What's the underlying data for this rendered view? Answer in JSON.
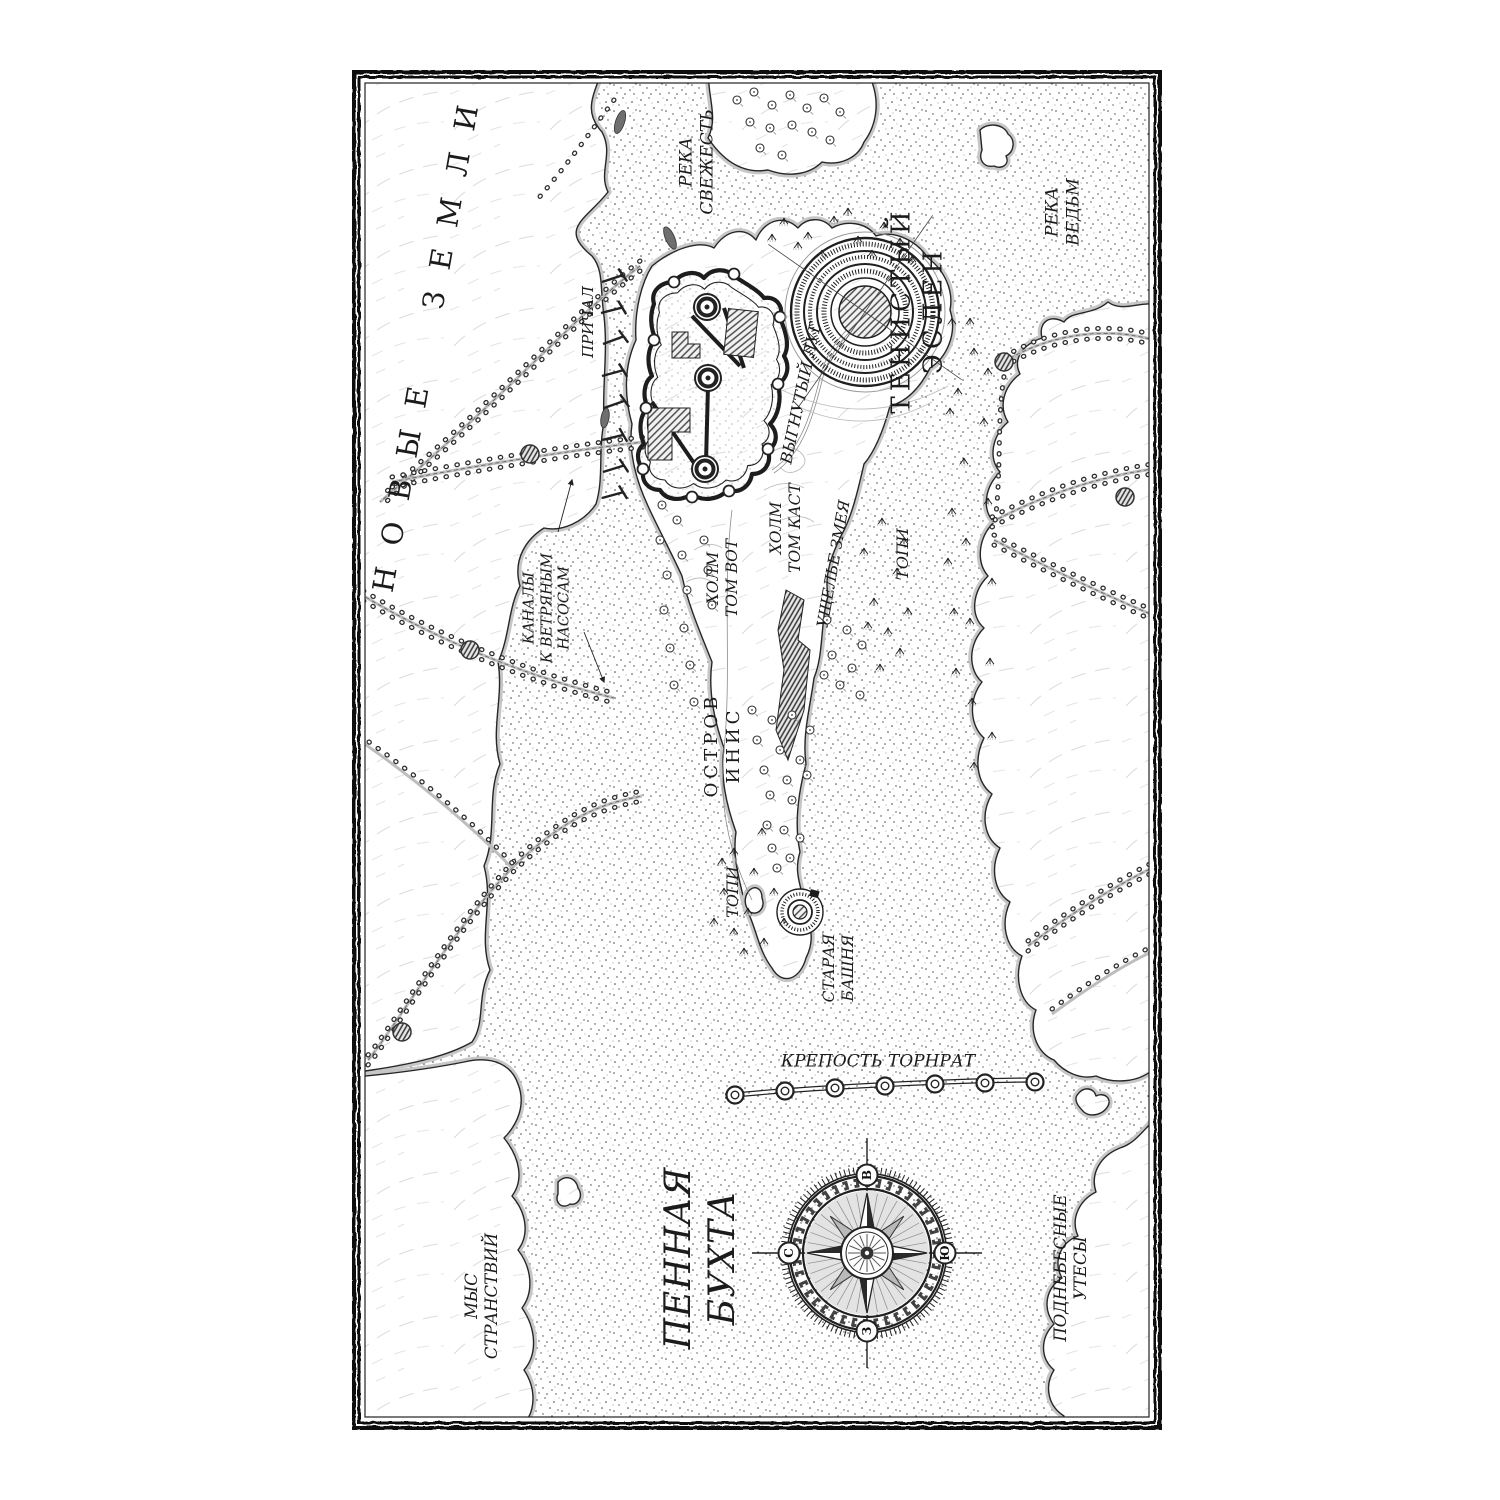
{
  "map": {
    "labels": {
      "new_lands": "НОВЫЕ ЗЕМЛИ",
      "river_svezhest": "РЕКА\nСВЕЖЕСТЬ",
      "river_vedm": "РЕКА\nВЕДЬМ",
      "prichal": "ПРИЧАЛ",
      "tenisty_eslen": "ТЕНИСТЫЙ\nЭСЛЕН",
      "vygnuty_lug": "ВЫГНУТЫЙ ЛУГ",
      "kholm_tom_kast": "ХОЛМ\nТОМ КАСТ",
      "kholm_tom_vot": "ХОЛМ\nТОМ ВОТ",
      "ushchelye_zmeya": "УЩЕЛЬЕ ЗМЕЯ",
      "topi_east": "ТОПИ",
      "kanaly": "КАНАЛЫ\nК ВЕТРЯНЫМ\nНАСОСАМ",
      "ostrov_inis": "ОСТРОВ\nИНИС",
      "topi_south": "ТОПИ",
      "staraya_bashnya": "СТАРАЯ\nБАШНЯ",
      "krepost_tornrat": "КРЕПОСТЬ ТОРНРАТ",
      "pennaya_bukhta": "ПЕННАЯ\nБУХТА",
      "mys_stranstviy": "МЫС\nСТРАНСТВИЙ",
      "podnebesnye_utesy": "ПОДНЕБЕСНЫЕ\nУТЕСЫ"
    },
    "compass": {
      "north": "С",
      "east": "В",
      "south": "Ю",
      "west": "З"
    },
    "colors": {
      "ink": "#1b1b1b",
      "paper": "#ffffff",
      "water_stipple": "#3d3d3d",
      "shore_halo": "#c6c6c6"
    }
  }
}
